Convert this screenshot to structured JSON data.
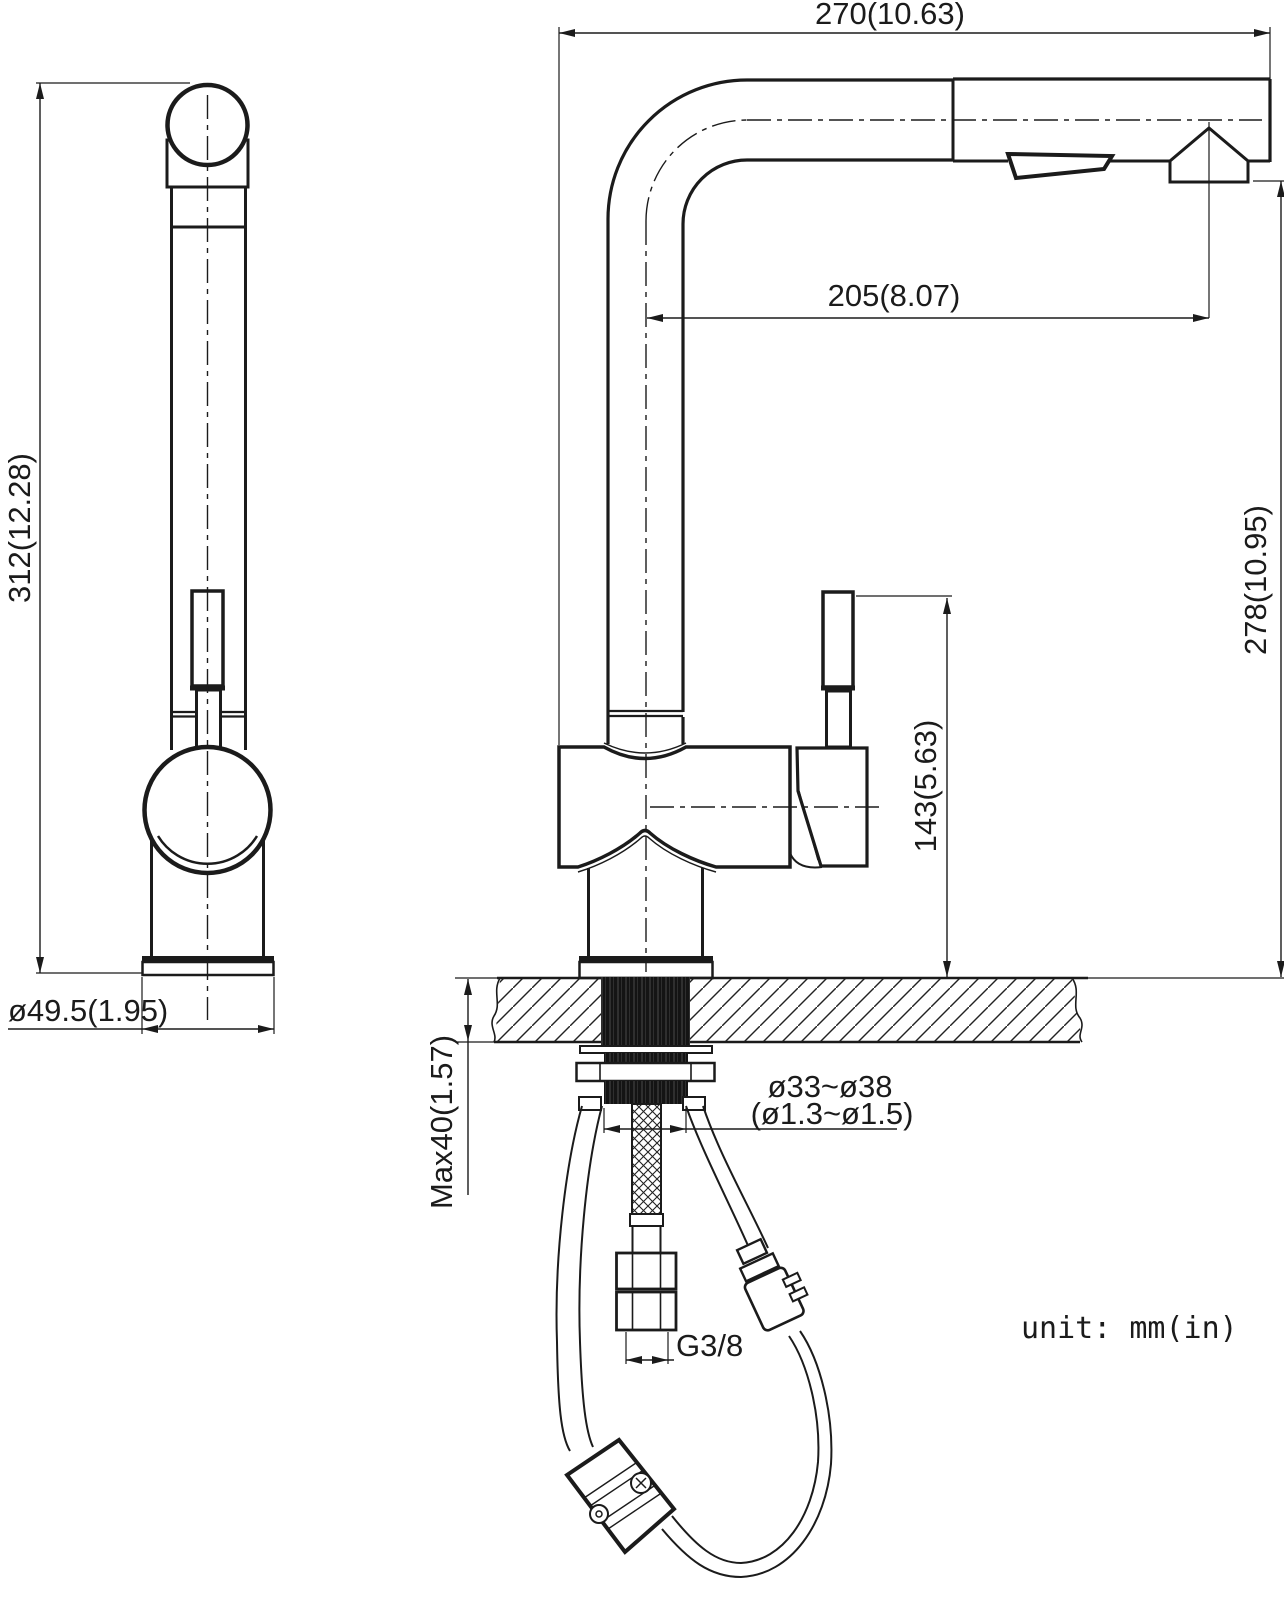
{
  "drawing": {
    "title": "pull-out kitchen faucet installation dimensions",
    "unit_note": "unit: mm(in)",
    "dimensions": {
      "spout_width": "270(10.63)",
      "spout_reach": "205(8.07)",
      "side_height": "312(12.28)",
      "front_height": "278(10.95)",
      "handle_height": "143(5.63)",
      "base_diameter": "ø49.5(1.95)",
      "deck_thickness": "Max40(1.57)",
      "hole_diameter_mm": "ø33~ø38",
      "hole_diameter_in": "(ø1.3~ø1.5)",
      "supply_thread": "G3/8"
    },
    "colors": {
      "line": "#1b1b1b",
      "background": "#ffffff"
    }
  }
}
